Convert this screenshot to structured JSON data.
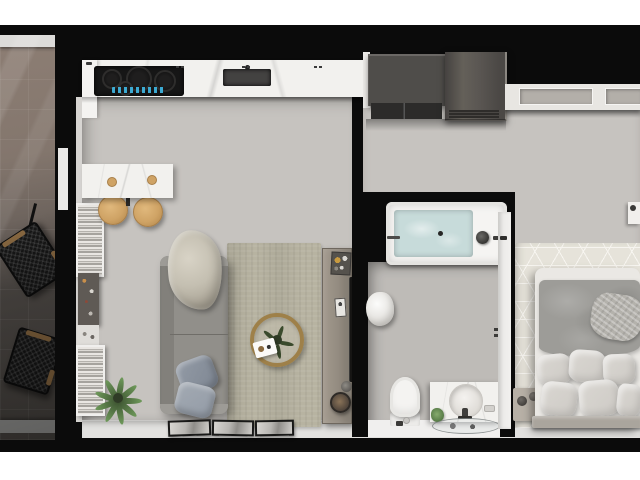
{
  "meta": {
    "description": "Photorealistic 3D top-down floor plan render of a studio apartment with balcony, kitchen, living room, hallway, bathroom and bedroom. No visible text in the image.",
    "view": "top-down isometric render",
    "canvas": {
      "width": 640,
      "height": 480
    }
  },
  "palette": {
    "pageBg": "#ffffff",
    "wall": "#0b0b0b",
    "floorBase": "#c6c3bf",
    "marble": "#f2f1ee",
    "darkUnit": "#4f4d4a",
    "darkUnitLow": "#2c2b2a",
    "fridge1": "#5b5753",
    "fridge2": "#454240",
    "cooktop": "#161616",
    "display": "#3fb9e6",
    "sinkDark": "#434241",
    "balconySillTop": "#dcdbd9",
    "balconySillBottom": "#9b9b99",
    "chair": "#171717",
    "chairWood": "#8b6a42",
    "barWood": "#cfa365",
    "bookLight": "#e9e6e2",
    "bookDark": "#a6a39e",
    "decorShelf": "#5f5a55",
    "plantGreen": "#6f9a5b",
    "sofa": "#918f8a",
    "sofaDark": "#82807b",
    "blanket1": "#d8d3c6",
    "blanket2": "#a9a395",
    "pillowBlue1": "#939ba6",
    "pillowBlue2": "#7e8692",
    "rug": "#b7b3a1",
    "tableRing": "#9e8049",
    "console1": "#a39a8e",
    "console2": "#7d766c",
    "tv": "#161514",
    "frameEdge": "#191918",
    "tub": "#f5f4f2",
    "water": "#c7dbda",
    "porcelain": "#f4f3f1",
    "doorWhite": "#f2f1ef",
    "bedRug": "#e6e3da",
    "bedRugLine": "#f7f5f0",
    "mattress": "#eae8e4",
    "duvet": "#9d9c98",
    "throw": "#b4b2ac",
    "pillowLight": "#dad7d2",
    "pillowLight2": "#cdcac5",
    "headboard": "#aaa59d",
    "nightstand": "#b7b0a6",
    "wardrobeFrame": "#e8e6e2",
    "wardrobePanel": "#b3afa9",
    "bottomStrip": "#e2e1df"
  },
  "rooms": {
    "balcony": {
      "label": "balcony",
      "furniture": [
        "wicker-lounge-chair",
        "wicker-lounge-chair"
      ]
    },
    "kitchen": {
      "label": "kitchen",
      "furniture": [
        "marble-counter",
        "induction-cooktop-with-blue-display",
        "undermount-sink",
        "tall-cabinet",
        "dark-cabinet",
        "refrigerator",
        "bar-table",
        "bar-stool",
        "bar-stool"
      ]
    },
    "living_room": {
      "label": "living room",
      "furniture": [
        "bookshelf",
        "decor-shelf",
        "corner-plant",
        "sofa",
        "throw-blanket",
        "two-pillows",
        "area-rug",
        "round-rattan-coffee-table",
        "serving-tray",
        "media-console",
        "wall-mounted-tv",
        "three-leaning-framed-pictures"
      ]
    },
    "hallway": {
      "label": "hallway",
      "furniture": []
    },
    "bathroom": {
      "label": "bathroom",
      "furniture": [
        "bathtub-with-water",
        "faucet",
        "towel-bar",
        "towel-bundle",
        "toilet",
        "vanity-with-round-basin",
        "glass-shelf",
        "door"
      ]
    },
    "bedroom": {
      "label": "bedroom",
      "furniture": [
        "built-in-wardrobe",
        "patterned-rug",
        "double-bed",
        "duvet",
        "knit-throw",
        "six-pillows",
        "nightstand",
        "wall-shelf"
      ]
    }
  }
}
